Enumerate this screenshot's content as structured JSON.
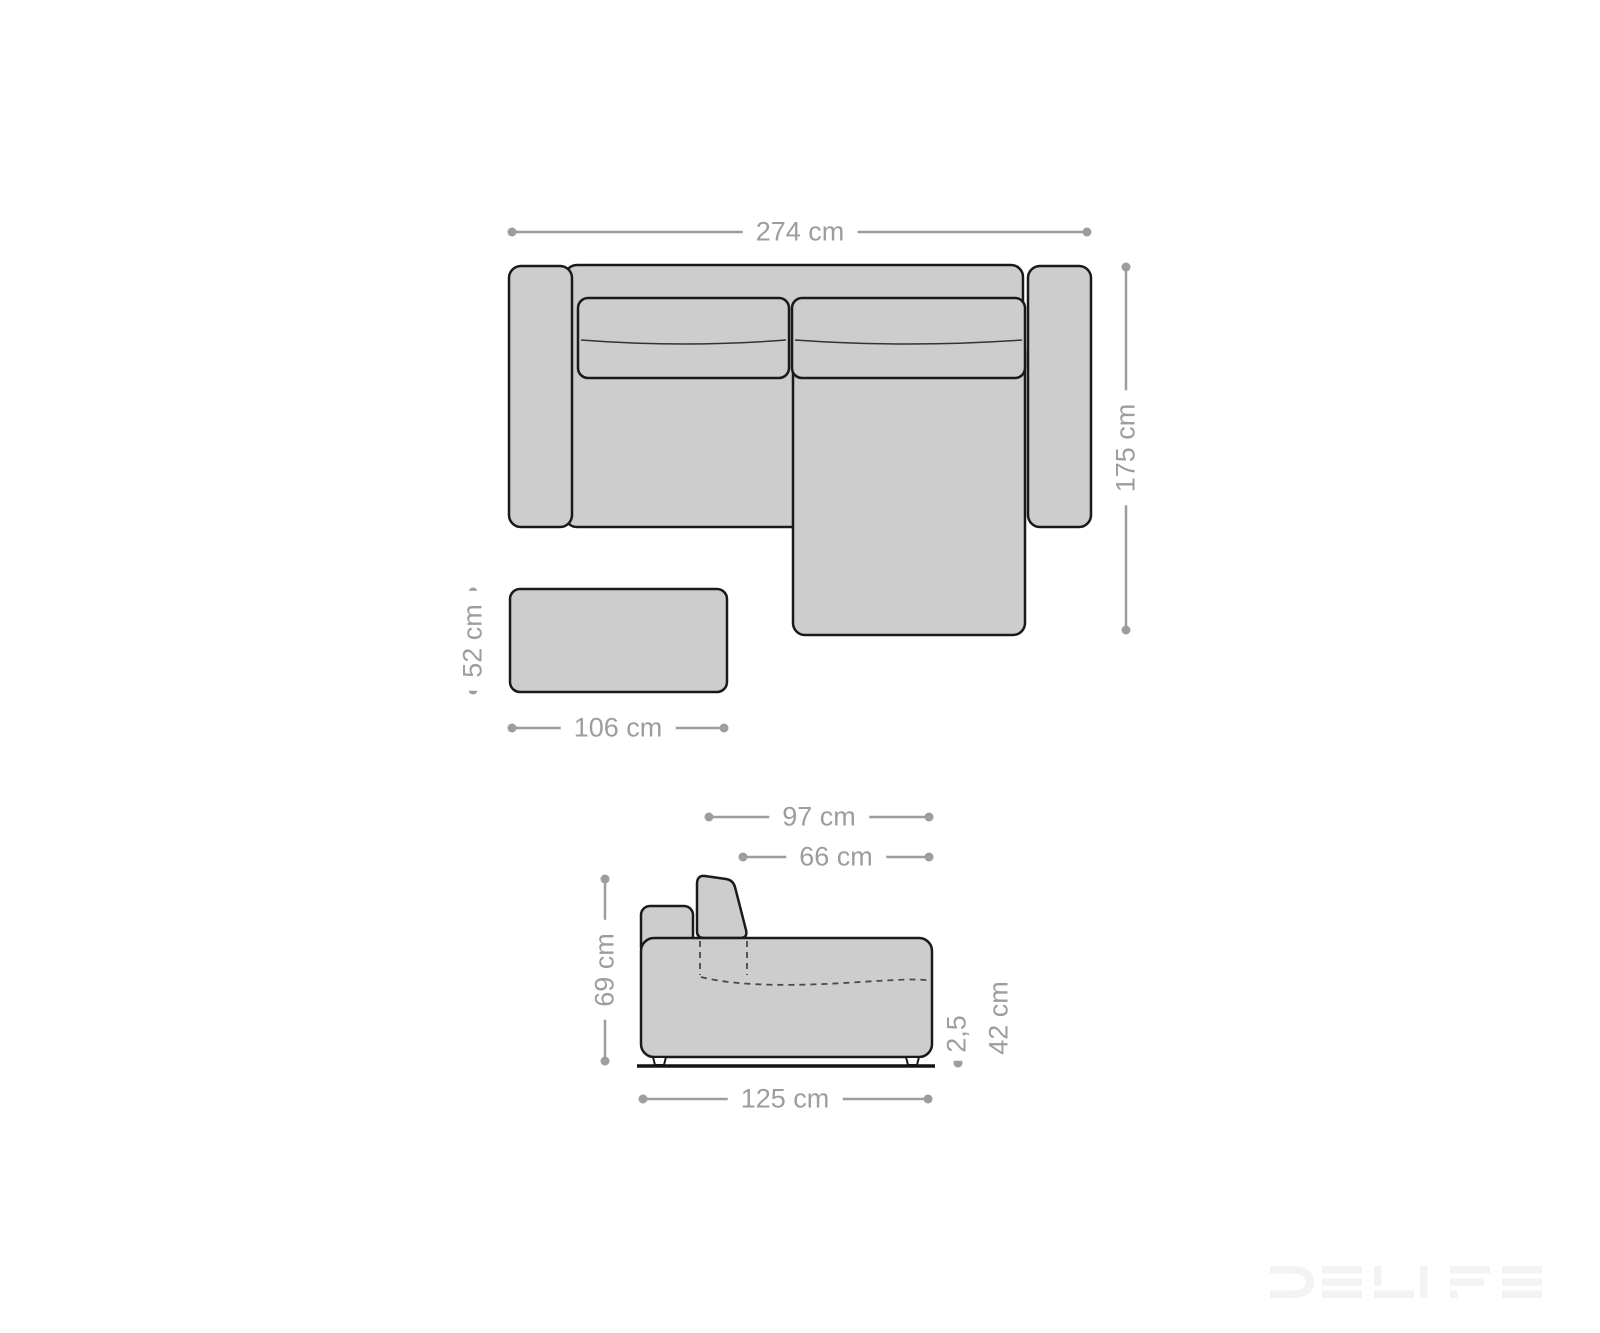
{
  "page": {
    "background": "#ffffff"
  },
  "colors": {
    "dimension_gray": "#9d9d9d",
    "furniture_fill": "#cdcdcd",
    "furniture_stroke": "#1a1a1a",
    "ground_line": "#141414",
    "watermark_gray": "#f3f3f3"
  },
  "top_view": {
    "sofa_width_label": "274 cm",
    "sofa_depth_label": "175 cm",
    "stool_depth_label": "52 cm",
    "stool_width_label": "106 cm"
  },
  "side_view": {
    "total_depth_label": "97 cm",
    "seat_depth_label": "66 cm",
    "back_height_label": "69 cm",
    "base_height_label": "2,5",
    "seat_height_label": "42 cm",
    "module_width_label": "125 cm"
  },
  "watermark": {
    "text": "DELIFE"
  }
}
